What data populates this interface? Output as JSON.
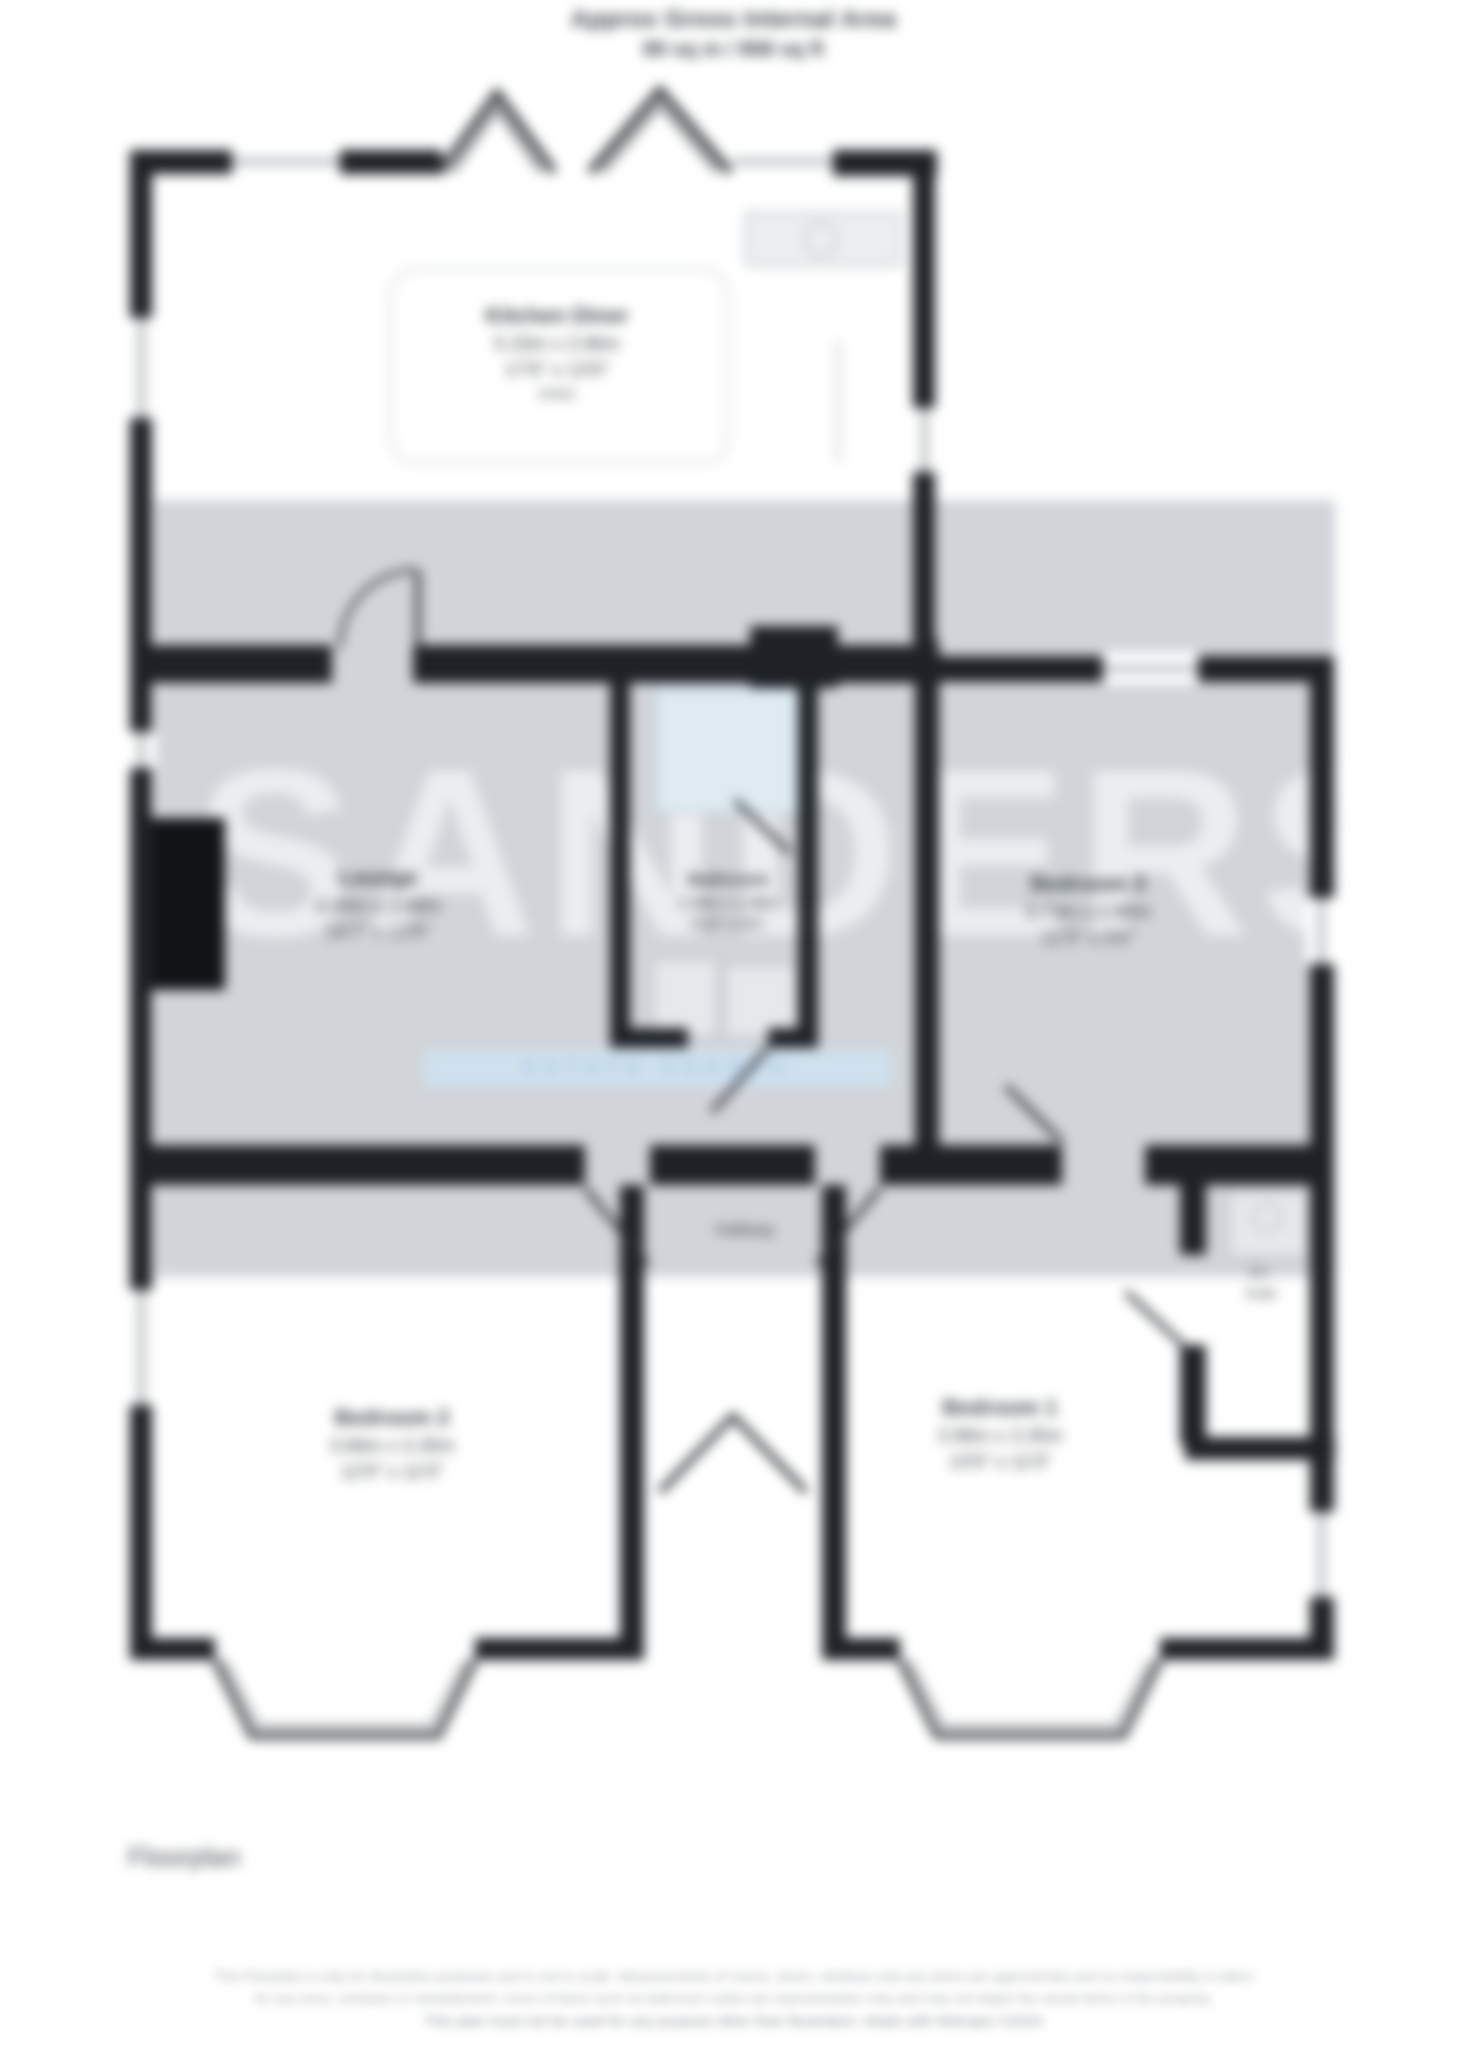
{
  "title": {
    "line1": "Approx Gross Internal Area",
    "line2": "89 sq m / 958 sq ft"
  },
  "watermark": {
    "text": "SANDERS",
    "tagline": "ESTATE AGENTS"
  },
  "rooms": {
    "kitchen": {
      "name": "Kitchen Diner",
      "metric": "5.33m x 3.96m",
      "imperial": "17'6\" x 13'0\"",
      "note": "(max)"
    },
    "lounge": {
      "name": "Lounge",
      "metric": "4.45m x 3.66m",
      "imperial": "14'7\" x 12'0\""
    },
    "bathroom": {
      "name": "Bathroom",
      "metric": "2.08m x 1.98m",
      "imperial": "6'10\" x 6'6\""
    },
    "bedroom3": {
      "name": "Bedroom 3",
      "metric": "3.73m x 2.90m",
      "imperial": "12'3\" x 9'6\""
    },
    "bedroom2": {
      "name": "Bedroom 2",
      "metric": "3.66m x 3.35m",
      "imperial": "12'0\" x 11'0\""
    },
    "bedroom1": {
      "name": "Bedroom 1",
      "metric": "3.96m x 3.35m",
      "imperial": "13'0\" x 11'0\""
    },
    "hallway": {
      "name": "Hallway"
    },
    "ensuite": {
      "line1": "En-",
      "line2": "Suite"
    }
  },
  "floorplan_label": "Floorplan",
  "footer": {
    "line1": "This Floorplan is only for illustrative purposes and is not to scale. Measurements of rooms, doors, windows and any items are approximate and no responsibility is taken",
    "line2": "for any error, omission or misstatement. Icons of items such as bathroom suites are representative only and may not depict the actual items in the property.",
    "line3": "This plan must not be used for any purpose other than illustration. Made with Metropix ©2024"
  },
  "colors": {
    "wall": "#1e2226",
    "band": "#d1d5d9",
    "shower_blue": "#dfeaf3",
    "brand_blue": "#cfe1ef",
    "text": "#3d4247",
    "footer_text": "#a3a8ad"
  }
}
